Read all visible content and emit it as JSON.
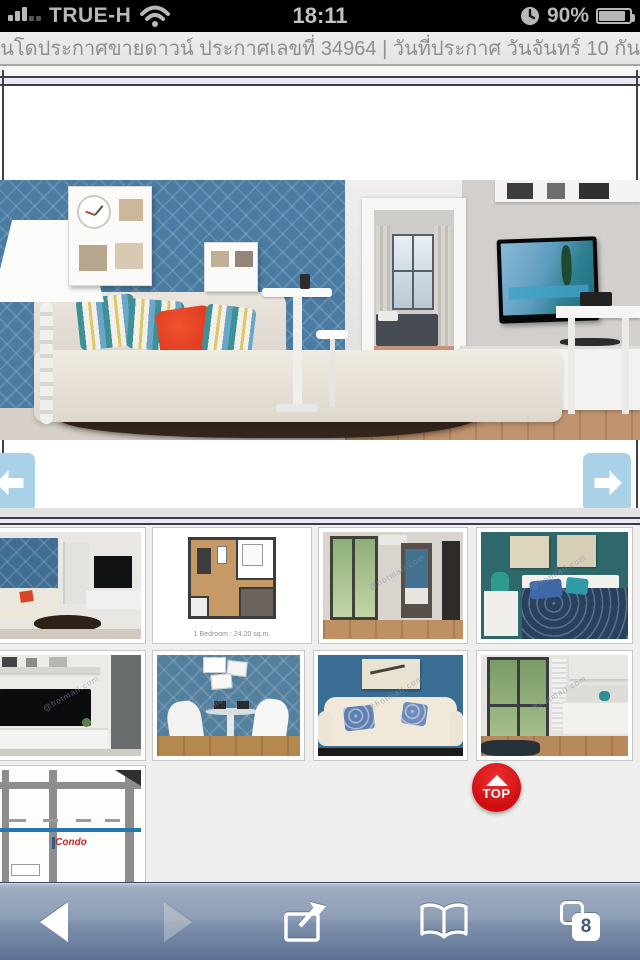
{
  "status_bar": {
    "carrier": "TRUE-H",
    "time": "18:11",
    "battery_percent": "90%",
    "icons": [
      "signal-bars-icon",
      "wifi-icon",
      "alarm-clock-icon",
      "battery-icon"
    ]
  },
  "title_bar": {
    "text": "อนโดประกาศขายดาวน์ ประกาศเลขที่ 34964 | วันที่ประกาศ วันจันทร์ 10 กันย"
  },
  "gallery": {
    "nav_icons": [
      "arrow-left-icon",
      "arrow-right-icon"
    ]
  },
  "thumbnails": {
    "floorplan_caption": "1 Bedroom : 24.20 sq.m.",
    "watermark": "@hotmail.com",
    "map_brand": "Condo",
    "items": [
      "living-room",
      "floor-plan",
      "balcony-room",
      "bedroom",
      "tv-unit",
      "dining-area",
      "sofa",
      "kitchen-balcony",
      "location-map"
    ]
  },
  "top_button": {
    "label": "TOP",
    "icon": "arrow-up-icon"
  },
  "toolbar": {
    "tab_count": "8",
    "icons": [
      "back-icon",
      "forward-icon",
      "share-icon",
      "bookmarks-icon",
      "pages-icon"
    ]
  },
  "colors": {
    "status_gray": "#b8b8b8",
    "arrow_blue": "#a9d2e8",
    "top_red": "#cf0d12",
    "wall_blue": "#4a7ca3",
    "toolbar_blue": "#7e90ab"
  }
}
